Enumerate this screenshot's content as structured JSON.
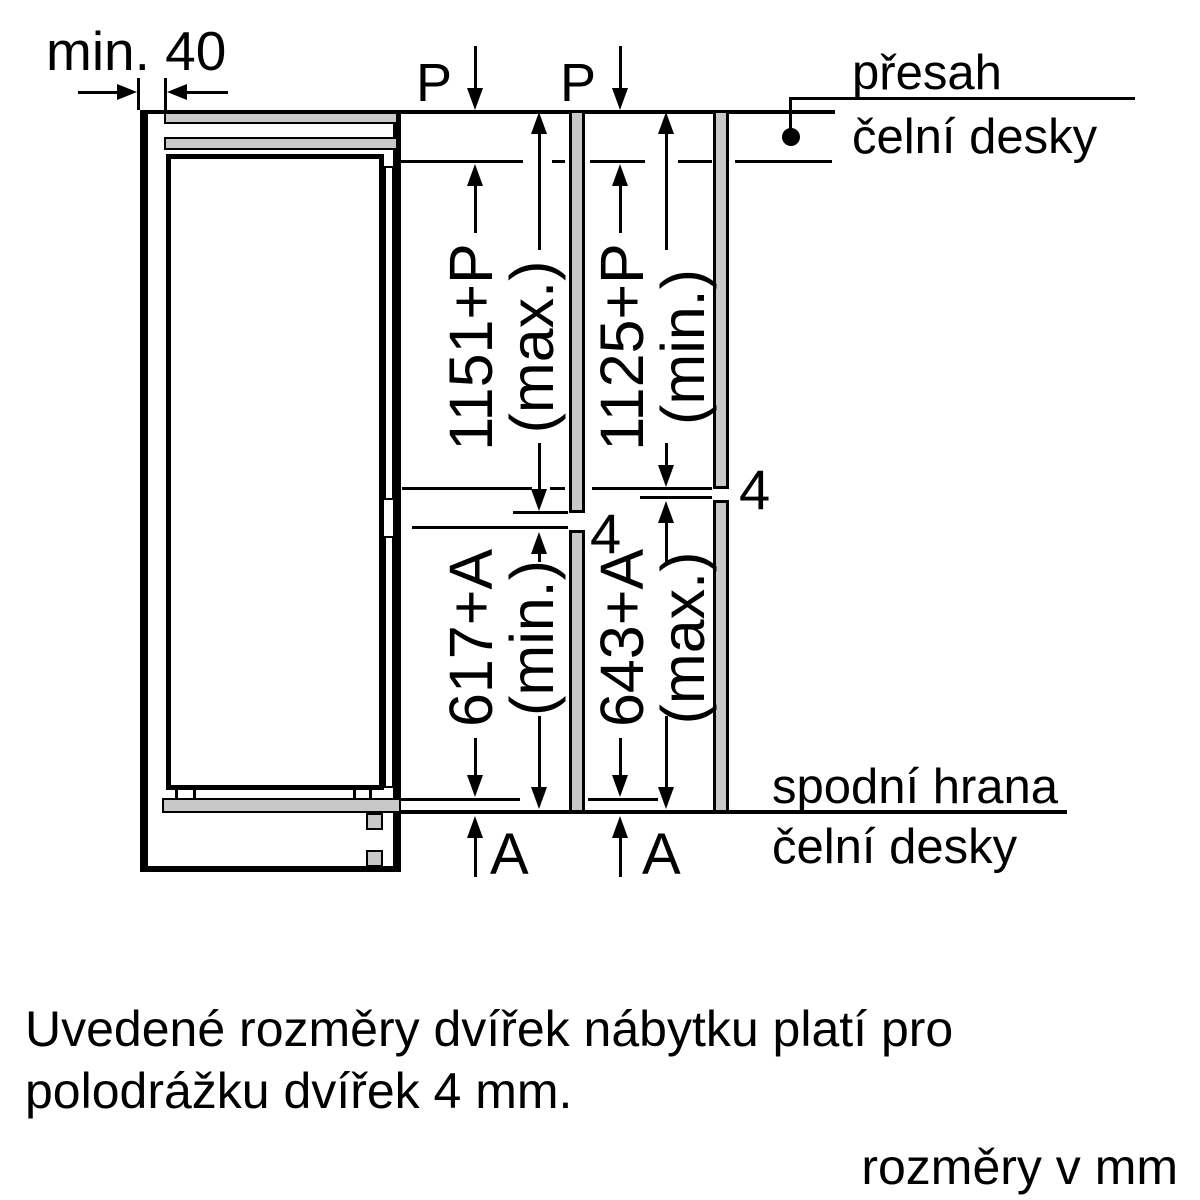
{
  "min_clearance_label": "min. 40",
  "labels": {
    "p": "P",
    "a": "A",
    "gap": "4"
  },
  "dimensions": {
    "upper_left": {
      "value": "1151+P",
      "qualifier": "(max.)"
    },
    "upper_right": {
      "value": "1125+P",
      "qualifier": "(min.)"
    },
    "lower_left": {
      "value": "617+A",
      "qualifier": "(min.)"
    },
    "lower_right": {
      "value": "643+A",
      "qualifier": "(max.)"
    }
  },
  "annotations": {
    "top_right_line1": "přesah",
    "top_right_line2": "čelní desky",
    "bottom_right_line1": "spodní hrana",
    "bottom_right_line2": "čelní desky"
  },
  "notes": {
    "line1": "Uvedené rozměry dvířek nábytku platí pro",
    "line2": "polodrážku dvířek 4 mm.",
    "units": "rozměry v mm"
  },
  "colors": {
    "line": "#000000",
    "panel_fill": "#c8c8c8",
    "background": "#ffffff"
  }
}
